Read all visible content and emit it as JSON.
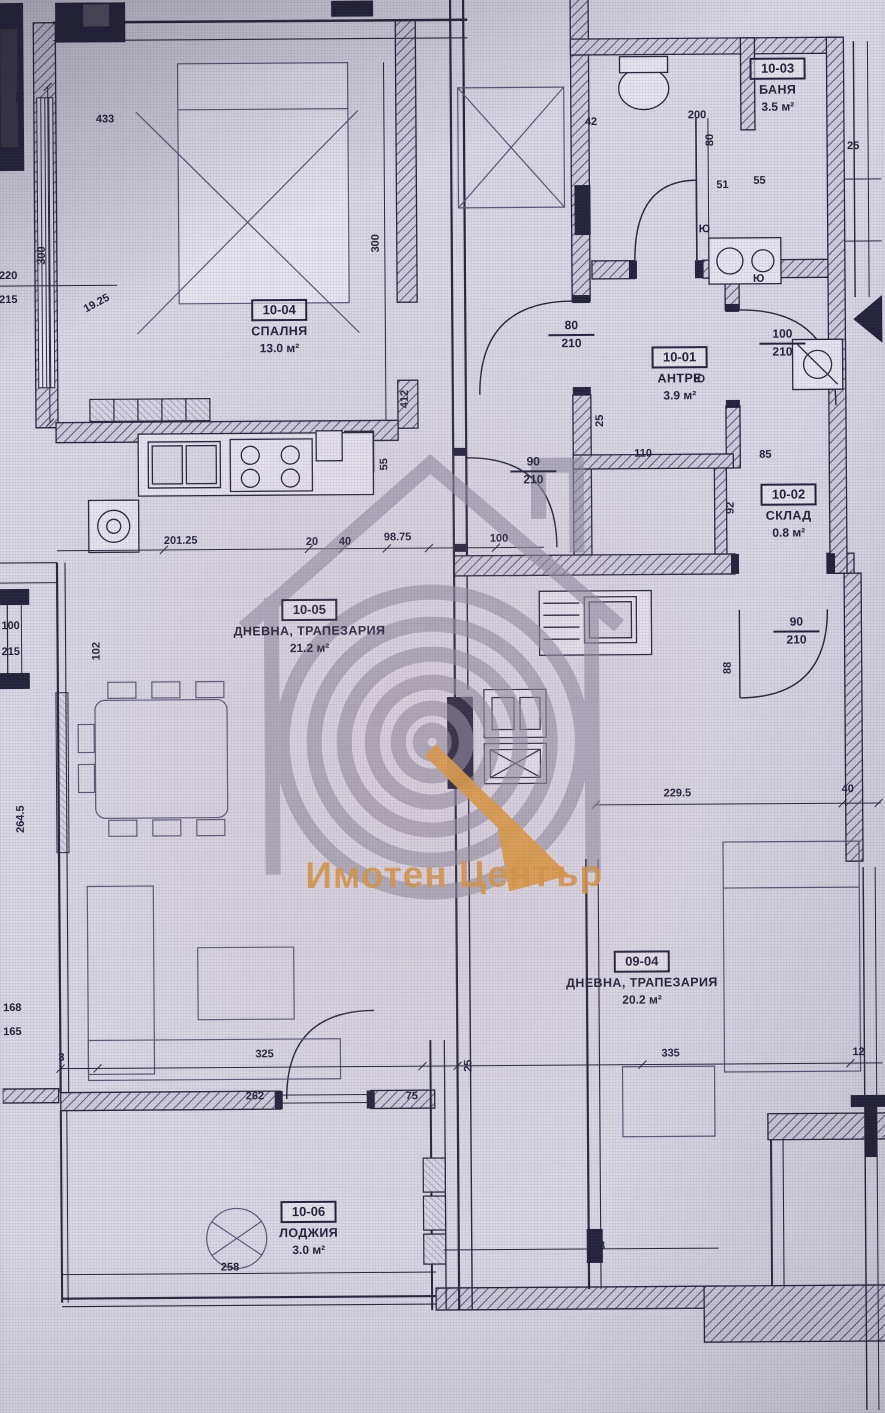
{
  "watermark": {
    "brand": "Имотен Център",
    "accent_color": "#d8963f",
    "logo_color": "#8f8da0"
  },
  "colors": {
    "line": "#26253a",
    "paper": "#d9d7e3"
  },
  "rooms": [
    {
      "id": "10-03",
      "name": "БАНЯ",
      "area": "3.5 м²"
    },
    {
      "id": "10-04",
      "name": "СПАЛНЯ",
      "area": "13.0 м²"
    },
    {
      "id": "10-01",
      "name": "АНТРЕ",
      "area": "3.9 м²"
    },
    {
      "id": "10-02",
      "name": "СКЛАД",
      "area": "0.8 м²"
    },
    {
      "id": "10-05",
      "name": "ДНЕВНА, ТРАПЕЗАРИЯ",
      "area": "21.2 м²"
    },
    {
      "id": "09-04",
      "name": "ДНЕВНА, ТРАПЕЗАРИЯ",
      "area": "20.2 м²"
    },
    {
      "id": "10-06",
      "name": "ЛОДЖИЯ",
      "area": "3.0 м²"
    }
  ],
  "dims": [
    "433",
    "79",
    "300",
    "300",
    "220",
    "215",
    "19.25",
    "80",
    "210",
    "25",
    "110",
    "90",
    "210",
    "100",
    "210",
    "51",
    "55",
    "42",
    "200",
    "25",
    "92",
    "85",
    "201.25",
    "20",
    "40",
    "98.75",
    "100",
    "55",
    "412",
    "100",
    "215",
    "102",
    "264.5",
    "168",
    "165",
    "3",
    "325",
    "262",
    "75",
    "25",
    "335",
    "12",
    "229.5",
    "40",
    "90",
    "210",
    "88",
    "258",
    "303",
    "80",
    "Ю",
    "Ю",
    "Ю"
  ]
}
